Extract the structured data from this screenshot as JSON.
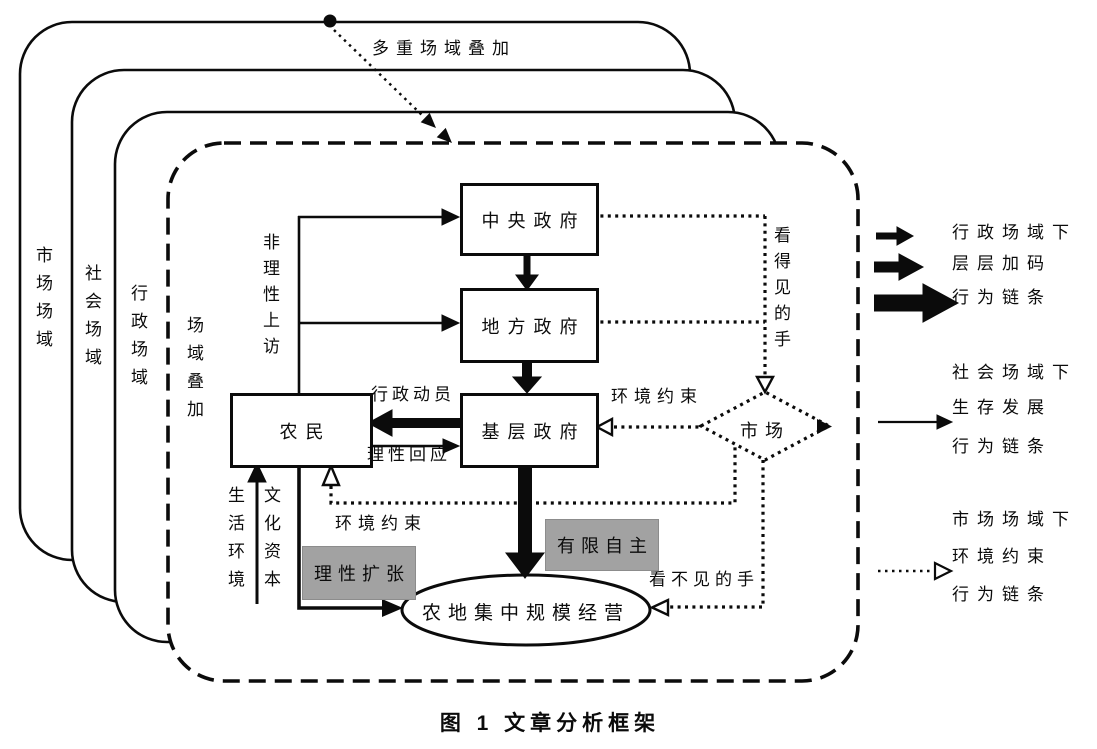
{
  "figure": {
    "caption": "图 1 文章分析框架"
  },
  "overlay_annotation": {
    "label": "多重场域叠加"
  },
  "fields": [
    {
      "label": "市场场域"
    },
    {
      "label": "社会场域"
    },
    {
      "label": "行政场域"
    },
    {
      "label": "场域叠加"
    }
  ],
  "nodes": {
    "central_gov": "中央政府",
    "local_gov": "地方政府",
    "grassroots_gov": "基层政府",
    "farmers": "农民",
    "market": "市场",
    "land_operation": "农地集中规模经营"
  },
  "edge_labels": {
    "irrational_petition": "非理性上访",
    "admin_mobilization": "行政动员",
    "rational_response": "理性回应",
    "env_constraint_market": "环境约束",
    "env_constraint_social": "环境约束",
    "visible_hand": "看得见的手",
    "invisible_hand": "看不见的手",
    "living_environment": "生活环境",
    "cultural_capital": "文化资本"
  },
  "highlights": {
    "rational_expansion": "理性扩张",
    "limited_autonomy": "有限自主"
  },
  "legend": {
    "items": [
      {
        "arrow_style": "layered-thick-black-arrows",
        "lines": [
          "行政场域下",
          "层层加码",
          "行为链条"
        ]
      },
      {
        "arrow_style": "thin-solid-arrow",
        "lines": [
          "社会场域下",
          "生存发展",
          "行为链条"
        ]
      },
      {
        "arrow_style": "dotted-open-arrow",
        "lines": [
          "市场场域下",
          "环境约束",
          "行为链条"
        ]
      }
    ]
  },
  "colors": {
    "ink": "#0b0b0b",
    "highlight_bg": "#a2a2a2",
    "background": "#ffffff"
  }
}
